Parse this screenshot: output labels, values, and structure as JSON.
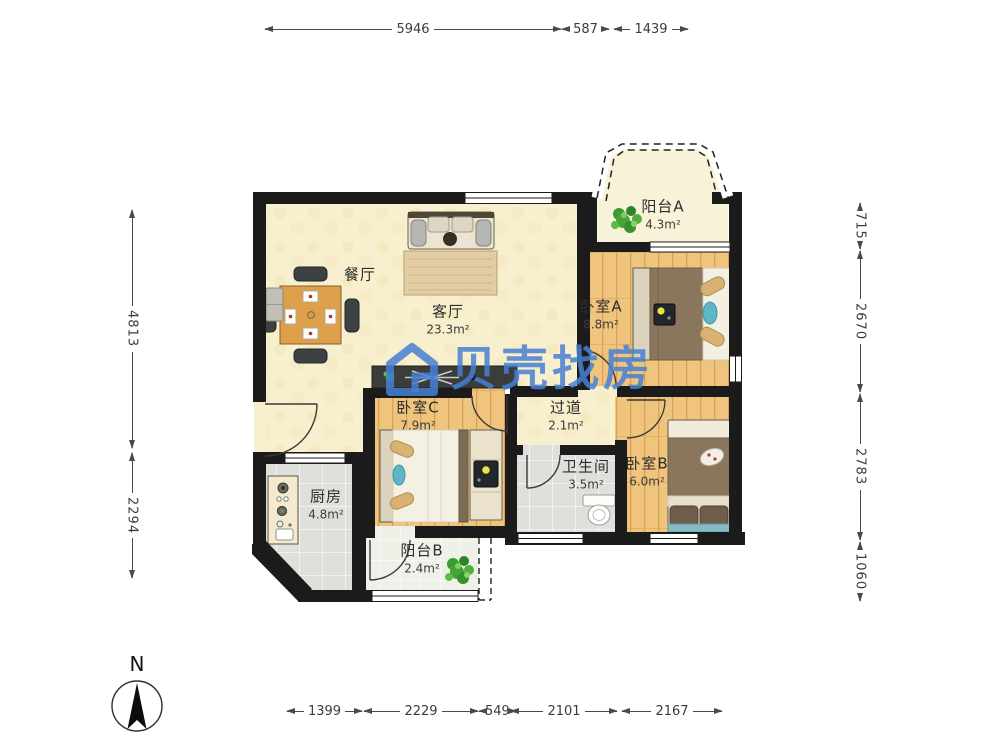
{
  "watermark": {
    "brand_text": "贝壳找房",
    "color": "#477fd2"
  },
  "compass": {
    "north_label": "N"
  },
  "rooms": {
    "dining": {
      "name": "餐厅"
    },
    "living": {
      "name": "客厅",
      "area": "23.3m²"
    },
    "balcony_a": {
      "name": "阳台A",
      "area": "4.3m²"
    },
    "bedroom_a": {
      "name": "卧室A",
      "area": "8.8m²"
    },
    "bedroom_c": {
      "name": "卧室C",
      "area": "7.9m²"
    },
    "hallway": {
      "name": "过道",
      "area": "2.1m²"
    },
    "bathroom": {
      "name": "卫生间",
      "area": "3.5m²"
    },
    "bedroom_b": {
      "name": "卧室B",
      "area": "6.0m²"
    },
    "kitchen": {
      "name": "厨房",
      "area": "4.8m²"
    },
    "balcony_b": {
      "name": "阳台B",
      "area": "2.4m²"
    }
  },
  "dimensions_mm": {
    "top": [
      "5946",
      "587",
      "1439"
    ],
    "left": [
      "4813",
      "2294"
    ],
    "right": [
      "715",
      "2670",
      "2783",
      "1060"
    ],
    "bottom": [
      "1399",
      "2229",
      "549",
      "2101",
      "2167"
    ]
  },
  "colors": {
    "wall": "#1b1b1b",
    "wood_floor": "#efc57e",
    "cream_floor": "#f7efcd",
    "tile_floor": "#dee1db",
    "watermark_blue": "#477fd2",
    "plant_green": "#3b9a31"
  }
}
